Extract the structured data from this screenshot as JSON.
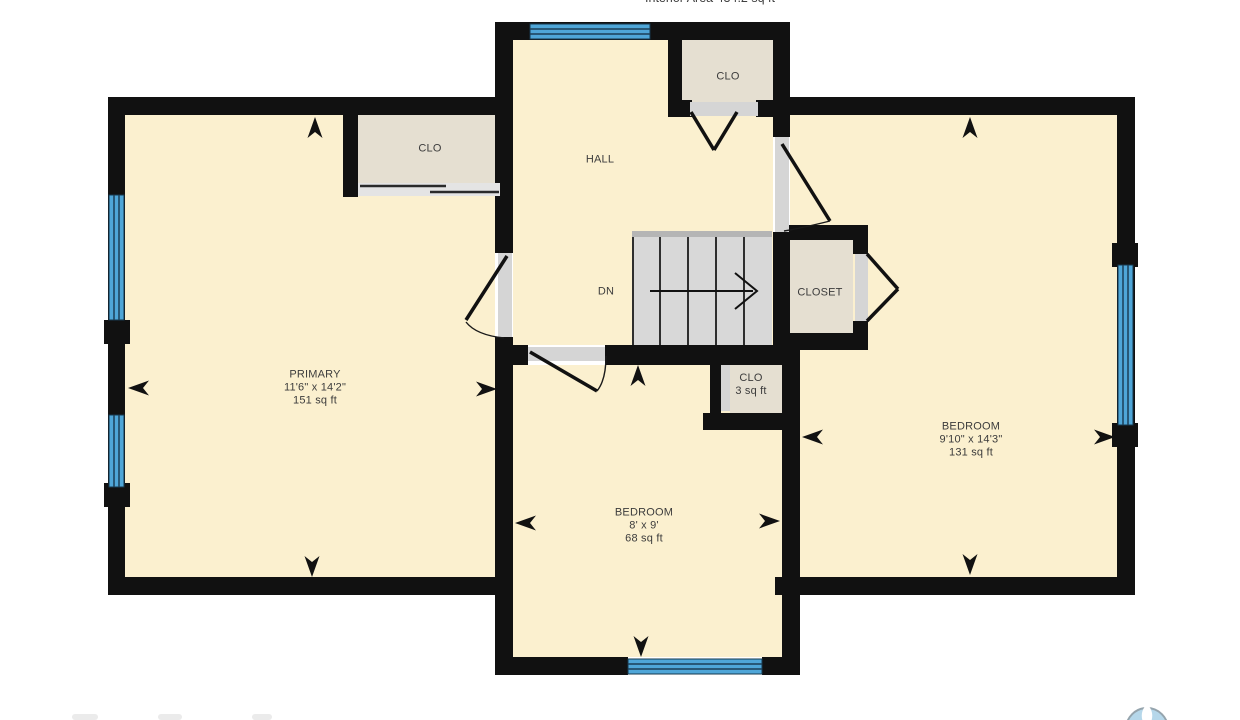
{
  "header": {
    "title": "Interior Area 434.2 sq ft"
  },
  "rooms": {
    "primary": {
      "name": "PRIMARY",
      "dims": "11'6\" x 14'2\"",
      "area": "151 sq ft"
    },
    "bedroom_bottom": {
      "name": "BEDROOM",
      "dims": "8' x 9'",
      "area": "68 sq ft"
    },
    "bedroom_right": {
      "name": "BEDROOM",
      "dims": "9'10\" x 14'3\"",
      "area": "131 sq ft"
    },
    "hall": {
      "name": "HALL"
    },
    "closet": {
      "name": "CLOSET"
    },
    "clo_top": {
      "name": "CLO"
    },
    "clo_primary": {
      "name": "CLO"
    },
    "clo_small": {
      "name": "CLO",
      "area": "3 sq ft"
    },
    "stairs": {
      "direction_label": "DN"
    }
  },
  "icons": {
    "stair_arrow": "right-chevron-arrow",
    "wall_markers": "cursor-arrowheads",
    "logo": "compass-circle-logo"
  },
  "colors": {
    "wall": "#111111",
    "room_fill": "#fbf0cf",
    "closet_fill": "#e5dfd1",
    "stair_fill": "#d8d8d8",
    "window": "#4fa6d8",
    "door_opening": "#d5d5d5",
    "logo_blue": "#b5d7ea"
  }
}
